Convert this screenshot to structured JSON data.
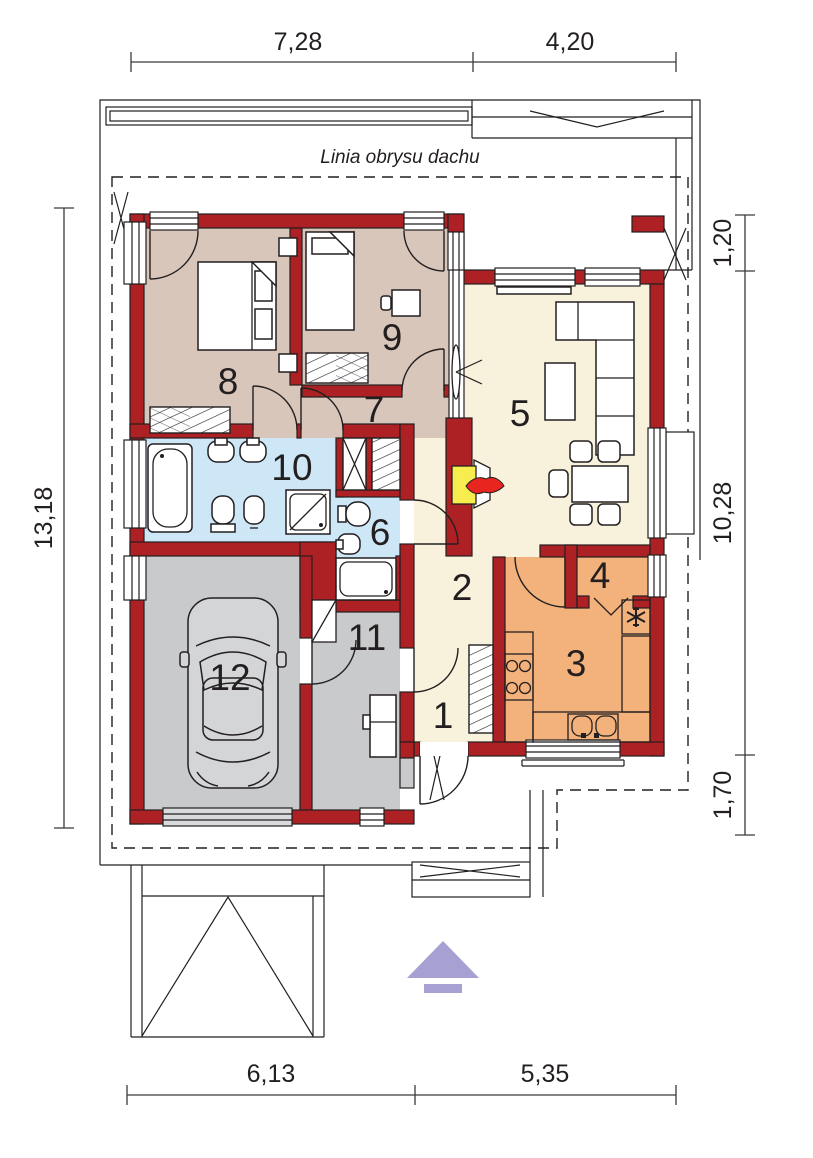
{
  "roof": {
    "label": "Linia obrysu dachu"
  },
  "dimensions": {
    "top": [
      "7,28",
      "4,20"
    ],
    "right": [
      "1,20",
      "10,28",
      "1,70"
    ],
    "bottom": [
      "6,13",
      "5,35"
    ],
    "left": [
      "13,18"
    ]
  },
  "rooms": [
    {
      "number": "1"
    },
    {
      "number": "2"
    },
    {
      "number": "3"
    },
    {
      "number": "4"
    },
    {
      "number": "5"
    },
    {
      "number": "6"
    },
    {
      "number": "7"
    },
    {
      "number": "8"
    },
    {
      "number": "9"
    },
    {
      "number": "10"
    },
    {
      "number": "11"
    },
    {
      "number": "12"
    }
  ],
  "colors": {
    "wall_red": "#ad2124",
    "bedroom_floor": "#d8c6ba",
    "living_floor": "#f8f2dc",
    "bathroom_floor": "#cde7f7",
    "garage_floor": "#c9cacb",
    "kitchen_floor": "#f3b27c",
    "fireplace_yellow": "#f7ed4e",
    "flame_red": "#e8251f",
    "arrow_lavender": "#a6a1d2",
    "line": "#231f20"
  }
}
